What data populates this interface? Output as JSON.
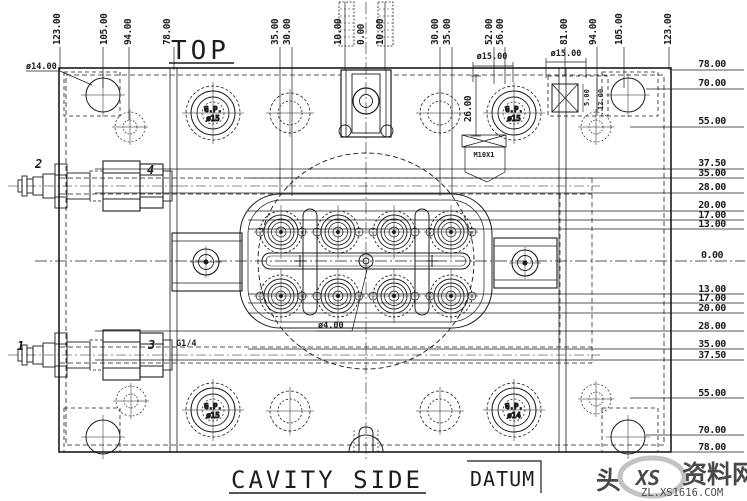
{
  "titles": {
    "view": "TOP",
    "bottom": "CAVITY SIDE",
    "datum": "DATUM"
  },
  "dims": {
    "top": [
      "123.00",
      "105.00",
      "94.00",
      "78.00",
      "35.00",
      "30.00",
      "10.00",
      "0.00",
      "10.00",
      "30.00",
      "35.00",
      "52.00",
      "56.00",
      "81.00",
      "94.00",
      "105.00",
      "123.00"
    ],
    "right": [
      "78.00",
      "70.00",
      "55.00",
      "37.50",
      "35.00",
      "28.00",
      "20.00",
      "17.00",
      "13.00",
      "0.00",
      "13.00",
      "17.00",
      "20.00",
      "28.00",
      "35.00",
      "37.50",
      "55.00",
      "70.00",
      "78.00"
    ]
  },
  "annotations": {
    "dia14": "ø14.00",
    "dia15_left": "ø15.00",
    "dia15_right": "ø15.00",
    "dia4": "ø4.00",
    "thread_m10": "M10X1",
    "thread_g14": "G1/4",
    "dim26": "26.00",
    "dim5": "5.00",
    "dim12": "12.00"
  },
  "guide_pins": {
    "name": "G.P.",
    "top_left_size": "ø15",
    "top_right_size": "ø15",
    "bottom_left_size": "ø15",
    "bottom_right_size": "ø14"
  },
  "balloons": [
    "1",
    "2",
    "3",
    "4"
  ],
  "watermark": {
    "prefix": "头",
    "logo": "XS",
    "brand": "资料网",
    "site": "ZL.XS1616.COM"
  }
}
